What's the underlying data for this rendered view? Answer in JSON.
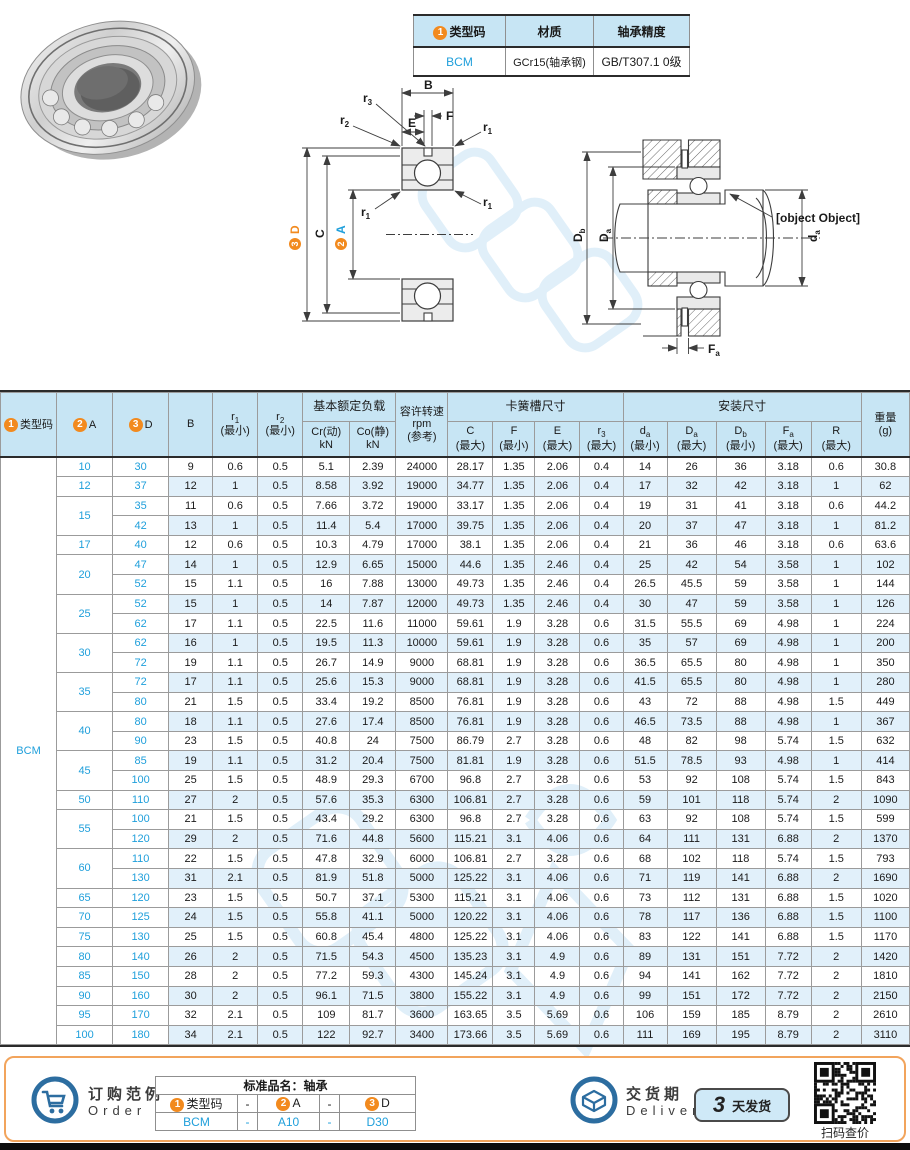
{
  "summary_table": {
    "headers": [
      {
        "badge": "1",
        "label": "类型码"
      },
      {
        "label": "材质"
      },
      {
        "label": "轴承精度"
      }
    ],
    "row": [
      "BCM",
      "GCr15(轴承钢)",
      "GB/T307.1 0级"
    ]
  },
  "front_diagram": {
    "B": "B",
    "E": "E",
    "F": "F",
    "C": "C",
    "r1": {
      "m": "r",
      "s": "1"
    },
    "r2": {
      "m": "r",
      "s": "2"
    },
    "r3": {
      "m": "r",
      "s": "3"
    },
    "D": {
      "badge": "3",
      "label": "D"
    },
    "A": {
      "badge": "2",
      "label": "A"
    }
  },
  "mount_diagram": {
    "Db": {
      "m": "D",
      "s": "b"
    },
    "Da": {
      "m": "D",
      "s": "a"
    },
    "da": {
      "m": "d",
      "s": "a"
    },
    "R": {
      "m": "R"
    },
    "Fa": {
      "m": "F",
      "s": "a"
    }
  },
  "table": {
    "type_code": "BCM",
    "header": {
      "col_type": {
        "badge": "1",
        "label": "类型码"
      },
      "col_a": {
        "badge": "2",
        "label": "A"
      },
      "col_d": {
        "badge": "3",
        "label": "D"
      },
      "col_b": "B",
      "col_r1": {
        "m": "r",
        "s": "1",
        "note": "(最小)"
      },
      "col_r2": {
        "m": "r",
        "s": "2",
        "note": "(最小)"
      },
      "group_load": "基本额定负载",
      "col_cr": {
        "line1": "Cr(动)",
        "line2": "kN"
      },
      "col_co": {
        "line1": "Co(静)",
        "line2": "kN"
      },
      "col_rpm": {
        "line1": "容许转速",
        "line2": "rpm",
        "line3": "(参考)"
      },
      "group_snap": "卡簧槽尺寸",
      "col_c": {
        "m": "C",
        "s": "",
        "note": "(最大)"
      },
      "col_f": {
        "m": "F",
        "s": "",
        "note": "(最小)"
      },
      "col_e": {
        "m": "E",
        "s": "",
        "note": "(最大)"
      },
      "col_r3": {
        "m": "r",
        "s": "3",
        "note": "(最大)"
      },
      "group_mount": "安装尺寸",
      "col_da": {
        "m": "d",
        "s": "a",
        "note": "(最小)"
      },
      "col_Da": {
        "m": "D",
        "s": "a",
        "note": "(最大)"
      },
      "col_Db": {
        "m": "D",
        "s": "b",
        "note": "(最小)"
      },
      "col_Fa": {
        "m": "F",
        "s": "a",
        "note": "(最大)"
      },
      "col_R": {
        "m": "R",
        "s": "",
        "note": "(最大)"
      },
      "col_weight": {
        "line1": "重量",
        "line2": "(g)"
      }
    },
    "rows": [
      [
        "10",
        "30",
        "9",
        "0.6",
        "0.5",
        "5.1",
        "2.39",
        "24000",
        "28.17",
        "1.35",
        "2.06",
        "0.4",
        "14",
        "26",
        "36",
        "3.18",
        "0.6",
        "30.8"
      ],
      [
        "12",
        "37",
        "12",
        "1",
        "0.5",
        "8.58",
        "3.92",
        "19000",
        "34.77",
        "1.35",
        "2.06",
        "0.4",
        "17",
        "32",
        "42",
        "3.18",
        "1",
        "62"
      ],
      [
        "15",
        "35",
        "11",
        "0.6",
        "0.5",
        "7.66",
        "3.72",
        "19000",
        "33.17",
        "1.35",
        "2.06",
        "0.4",
        "19",
        "31",
        "41",
        "3.18",
        "0.6",
        "44.2"
      ],
      [
        "15",
        "42",
        "13",
        "1",
        "0.5",
        "11.4",
        "5.4",
        "17000",
        "39.75",
        "1.35",
        "2.06",
        "0.4",
        "20",
        "37",
        "47",
        "3.18",
        "1",
        "81.2"
      ],
      [
        "17",
        "40",
        "12",
        "0.6",
        "0.5",
        "10.3",
        "4.79",
        "17000",
        "38.1",
        "1.35",
        "2.06",
        "0.4",
        "21",
        "36",
        "46",
        "3.18",
        "0.6",
        "63.6"
      ],
      [
        "20",
        "47",
        "14",
        "1",
        "0.5",
        "12.9",
        "6.65",
        "15000",
        "44.6",
        "1.35",
        "2.46",
        "0.4",
        "25",
        "42",
        "54",
        "3.58",
        "1",
        "102"
      ],
      [
        "20",
        "52",
        "15",
        "1.1",
        "0.5",
        "16",
        "7.88",
        "13000",
        "49.73",
        "1.35",
        "2.46",
        "0.4",
        "26.5",
        "45.5",
        "59",
        "3.58",
        "1",
        "144"
      ],
      [
        "25",
        "52",
        "15",
        "1",
        "0.5",
        "14",
        "7.87",
        "12000",
        "49.73",
        "1.35",
        "2.46",
        "0.4",
        "30",
        "47",
        "59",
        "3.58",
        "1",
        "126"
      ],
      [
        "25",
        "62",
        "17",
        "1.1",
        "0.5",
        "22.5",
        "11.6",
        "11000",
        "59.61",
        "1.9",
        "3.28",
        "0.6",
        "31.5",
        "55.5",
        "69",
        "4.98",
        "1",
        "224"
      ],
      [
        "30",
        "62",
        "16",
        "1",
        "0.5",
        "19.5",
        "11.3",
        "10000",
        "59.61",
        "1.9",
        "3.28",
        "0.6",
        "35",
        "57",
        "69",
        "4.98",
        "1",
        "200"
      ],
      [
        "30",
        "72",
        "19",
        "1.1",
        "0.5",
        "26.7",
        "14.9",
        "9000",
        "68.81",
        "1.9",
        "3.28",
        "0.6",
        "36.5",
        "65.5",
        "80",
        "4.98",
        "1",
        "350"
      ],
      [
        "35",
        "72",
        "17",
        "1.1",
        "0.5",
        "25.6",
        "15.3",
        "9000",
        "68.81",
        "1.9",
        "3.28",
        "0.6",
        "41.5",
        "65.5",
        "80",
        "4.98",
        "1",
        "280"
      ],
      [
        "35",
        "80",
        "21",
        "1.5",
        "0.5",
        "33.4",
        "19.2",
        "8500",
        "76.81",
        "1.9",
        "3.28",
        "0.6",
        "43",
        "72",
        "88",
        "4.98",
        "1.5",
        "449"
      ],
      [
        "40",
        "80",
        "18",
        "1.1",
        "0.5",
        "27.6",
        "17.4",
        "8500",
        "76.81",
        "1.9",
        "3.28",
        "0.6",
        "46.5",
        "73.5",
        "88",
        "4.98",
        "1",
        "367"
      ],
      [
        "40",
        "90",
        "23",
        "1.5",
        "0.5",
        "40.8",
        "24",
        "7500",
        "86.79",
        "2.7",
        "3.28",
        "0.6",
        "48",
        "82",
        "98",
        "5.74",
        "1.5",
        "632"
      ],
      [
        "45",
        "85",
        "19",
        "1.1",
        "0.5",
        "31.2",
        "20.4",
        "7500",
        "81.81",
        "1.9",
        "3.28",
        "0.6",
        "51.5",
        "78.5",
        "93",
        "4.98",
        "1",
        "414"
      ],
      [
        "45",
        "100",
        "25",
        "1.5",
        "0.5",
        "48.9",
        "29.3",
        "6700",
        "96.8",
        "2.7",
        "3.28",
        "0.6",
        "53",
        "92",
        "108",
        "5.74",
        "1.5",
        "843"
      ],
      [
        "50",
        "110",
        "27",
        "2",
        "0.5",
        "57.6",
        "35.3",
        "6300",
        "106.81",
        "2.7",
        "3.28",
        "0.6",
        "59",
        "101",
        "118",
        "5.74",
        "2",
        "1090"
      ],
      [
        "55",
        "100",
        "21",
        "1.5",
        "0.5",
        "43.4",
        "29.2",
        "6300",
        "96.8",
        "2.7",
        "3.28",
        "0.6",
        "63",
        "92",
        "108",
        "5.74",
        "1.5",
        "599"
      ],
      [
        "55",
        "120",
        "29",
        "2",
        "0.5",
        "71.6",
        "44.8",
        "5600",
        "115.21",
        "3.1",
        "4.06",
        "0.6",
        "64",
        "111",
        "131",
        "6.88",
        "2",
        "1370"
      ],
      [
        "60",
        "110",
        "22",
        "1.5",
        "0.5",
        "47.8",
        "32.9",
        "6000",
        "106.81",
        "2.7",
        "3.28",
        "0.6",
        "68",
        "102",
        "118",
        "5.74",
        "1.5",
        "793"
      ],
      [
        "60",
        "130",
        "31",
        "2.1",
        "0.5",
        "81.9",
        "51.8",
        "5000",
        "125.22",
        "3.1",
        "4.06",
        "0.6",
        "71",
        "119",
        "141",
        "6.88",
        "2",
        "1690"
      ],
      [
        "65",
        "120",
        "23",
        "1.5",
        "0.5",
        "50.7",
        "37.1",
        "5300",
        "115.21",
        "3.1",
        "4.06",
        "0.6",
        "73",
        "112",
        "131",
        "6.88",
        "1.5",
        "1020"
      ],
      [
        "70",
        "125",
        "24",
        "1.5",
        "0.5",
        "55.8",
        "41.1",
        "5000",
        "120.22",
        "3.1",
        "4.06",
        "0.6",
        "78",
        "117",
        "136",
        "6.88",
        "1.5",
        "1100"
      ],
      [
        "75",
        "130",
        "25",
        "1.5",
        "0.5",
        "60.8",
        "45.4",
        "4800",
        "125.22",
        "3.1",
        "4.06",
        "0.6",
        "83",
        "122",
        "141",
        "6.88",
        "1.5",
        "1170"
      ],
      [
        "80",
        "140",
        "26",
        "2",
        "0.5",
        "71.5",
        "54.3",
        "4500",
        "135.23",
        "3.1",
        "4.9",
        "0.6",
        "89",
        "131",
        "151",
        "7.72",
        "2",
        "1420"
      ],
      [
        "85",
        "150",
        "28",
        "2",
        "0.5",
        "77.2",
        "59.3",
        "4300",
        "145.24",
        "3.1",
        "4.9",
        "0.6",
        "94",
        "141",
        "162",
        "7.72",
        "2",
        "1810"
      ],
      [
        "90",
        "160",
        "30",
        "2",
        "0.5",
        "96.1",
        "71.5",
        "3800",
        "155.22",
        "3.1",
        "4.9",
        "0.6",
        "99",
        "151",
        "172",
        "7.72",
        "2",
        "2150"
      ],
      [
        "95",
        "170",
        "32",
        "2.1",
        "0.5",
        "109",
        "81.7",
        "3600",
        "163.65",
        "3.5",
        "5.69",
        "0.6",
        "106",
        "159",
        "185",
        "8.79",
        "2",
        "2610"
      ],
      [
        "100",
        "180",
        "34",
        "2.1",
        "0.5",
        "122",
        "92.7",
        "3400",
        "173.66",
        "3.5",
        "5.69",
        "0.6",
        "111",
        "169",
        "195",
        "8.79",
        "2",
        "3110"
      ]
    ]
  },
  "footer": {
    "order": {
      "title_cn": "订购范例",
      "title_en": "Order",
      "table_title": "标准品名：轴承",
      "c1": {
        "badge": "1",
        "label": "类型码"
      },
      "dash1": "-",
      "c2": {
        "badge": "2",
        "label": "A"
      },
      "dash2": "-",
      "c3": {
        "badge": "3",
        "label": "D"
      },
      "v1": "BCM",
      "vdash1": "-",
      "v2": "A10",
      "vdash2": "-",
      "v3": "D30"
    },
    "delivery": {
      "title_cn": "交货期",
      "title_en": "Delivery",
      "days": "3",
      "days_label": "天发货"
    },
    "qr_caption": "扫码查价"
  }
}
